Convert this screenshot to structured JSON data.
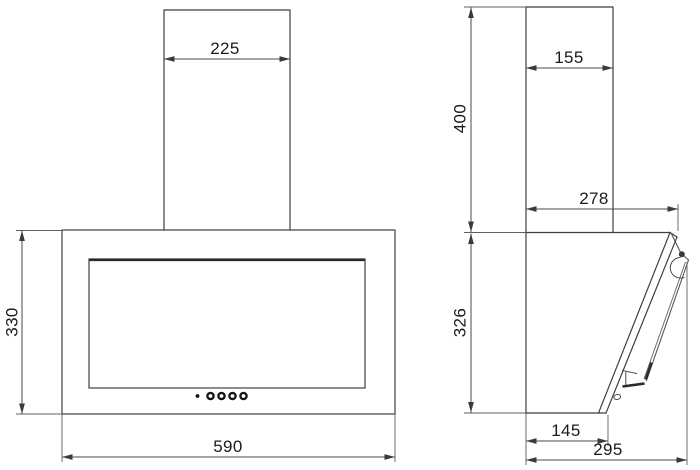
{
  "drawing": {
    "background_color": "#ffffff",
    "outline_color": "#3f3f3f",
    "dimension_line_color": "#4a4a4a",
    "text_color": "#1a1a1a"
  },
  "front_view": {
    "dimensions": {
      "chimney_width": "225",
      "body_height": "330",
      "body_width": "590"
    },
    "controls": {
      "indicator_dot_count": 1,
      "button_count": 4
    }
  },
  "side_view": {
    "dimensions": {
      "chimney_depth": "155",
      "chimney_height": "400",
      "top_depth": "278",
      "body_height": "326",
      "bottom_depth": "145",
      "overall_depth": "295"
    }
  }
}
